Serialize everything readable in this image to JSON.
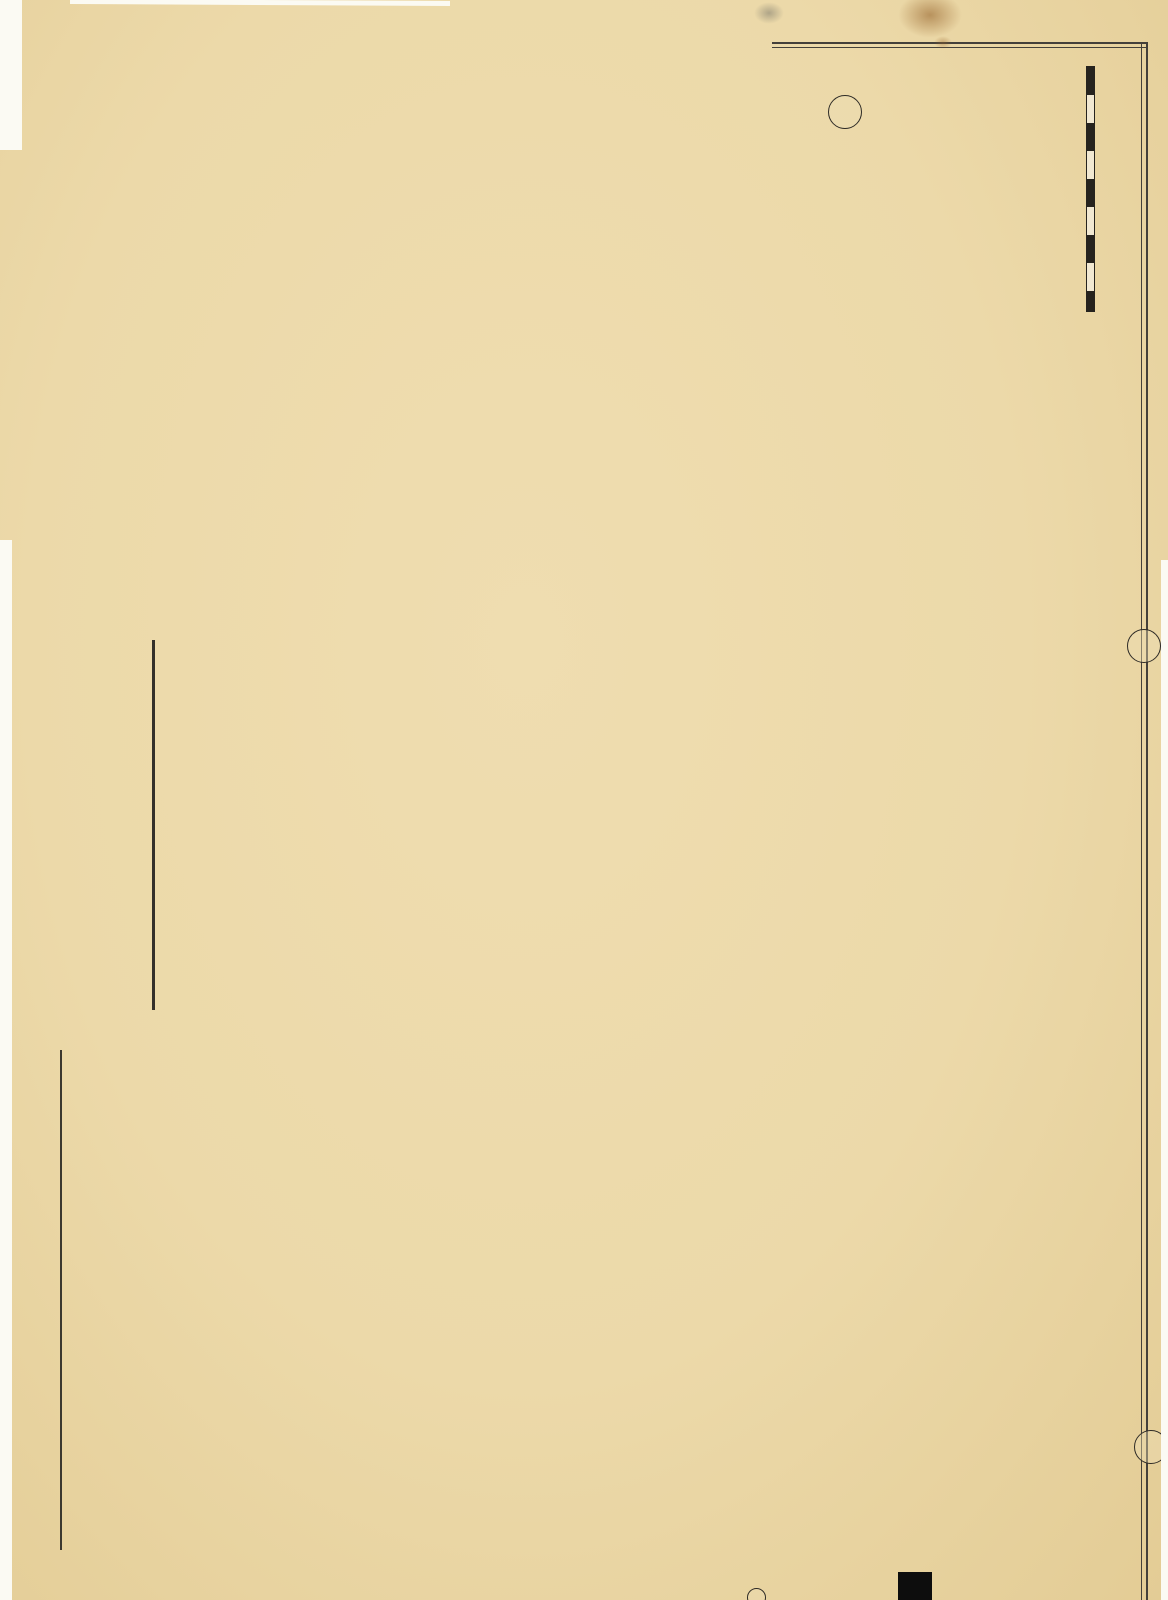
{
  "plate": {
    "number_title": "PLATE 41.",
    "city_title": "ROCHESTER.",
    "margin_note": "ALL FARM LOT Nos refer to 20,000 ACRE TRACT.",
    "scale_text": "Scale 250 feet to the inch",
    "scale_sec": "Sec.",
    "adjacent_plate_top": "23",
    "adjacent_plate_right": "40",
    "adjacent_plate_bottom": "2"
  },
  "watermark": "Historic Pictoric ®",
  "areas": {
    "maplewood": "MAPLEWOOD",
    "maplewood_park_word": "PARK",
    "genesee_river": "GENESEE RIVER",
    "seneca_park": "SENECA PARK",
    "seneca_park_strip": "SENECA PARK",
    "total_acres": "Total 115 acres",
    "kodak_park": "KODAK PARK",
    "eastman": "Eastman Kodak Co.",
    "kodak_note": "Buildings omitted upon request\nof the Eastman Kodak Co.",
    "fire_proof": "Fire Proof Film Co.",
    "fire_proof_acres": "17.32 a.",
    "ward10": "WD.10",
    "nazareth": "NAZARETH\nNORMAL\nSCHOOL",
    "town_of_greece": "TOWN OF GREECE",
    "lakeview_homestead": "LAKEVIEW HOMESTEAD",
    "gorsline": "GORSLINE",
    "maplewood_lake_tract": "MAPLEWOOD & LAKE AVE TRACT",
    "maplewood_tract": "MAPLEWOOD TRACT",
    "building": "BUILDING",
    "lot": "LOT",
    "assn": "ASS'N",
    "tract": "TRACT",
    "tract_sm": "TRACT",
    "city_big": "CITY",
    "flower_big": "FLOWER",
    "park_diag": "PARK",
    "land": "LAND",
    "sec8": "SEC. 8",
    "greece_letters": [
      "G",
      "R",
      "E",
      "E",
      "C",
      "E"
    ],
    "section_letters": [
      "A",
      "B",
      "C",
      "D",
      "E",
      "F"
    ],
    "scatter_letters": [
      "E",
      "E",
      "K",
      "T"
    ]
  },
  "farms": {
    "lucy_glass": "L u c y   G l a s s",
    "lucy_acres": "55a.",
    "stewart": "Wm & Alex W. Stewart",
    "stewart_acres": "18.87a.",
    "barker": "Hiram L. Barker",
    "barker_acres": "28.87a.",
    "britton": "W. N.  B r i t t o n",
    "britton_acres": "74 a.",
    "augell": "James E. Augell",
    "coeburn": "Geo. Coeburn",
    "heman": "Heman Glass",
    "coleman": "J. B. Coleman  4a.",
    "bygrave": "Sarah A. Bygrave",
    "city_realty": "City Realty Co."
  },
  "subs": {
    "watson": "WATSON & BROWN SUB",
    "crouch": "FRANK P. CROUCH SUB",
    "casper": "CASPER SUB",
    "langies": "LANGIE'S SUB",
    "parkdale": "PARKDALE TERRACE",
    "olmsted": "OLMSTED TRACT SUB",
    "louis": "LOUIS",
    "ellas": "ELLAS SUB"
  },
  "streets": {
    "lake": "LAKE",
    "ave": "AVE.",
    "dewey": "DEWEY",
    "ridge": "RIDGE",
    "road": "ROAD",
    "road2": "ROAD",
    "landing": "LANDING",
    "hansford": "HANSFORD",
    "lewiston": "LEWISTON",
    "knickerbocker": "KNICKERBOCKER",
    "pullman": "PULLMAN",
    "avis": "AVIS",
    "palm": "PALM",
    "dayton": "DAYTON",
    "primrose": "PRIMROSE ST",
    "marigold": "MARIGOLD ST",
    "daisy": "DAISY ST",
    "aster": "ASTER ST",
    "ridgeway": "RIDGEWAY",
    "flower_city_park": "FLOWER CITY PARK",
    "clay": "CLAY",
    "electric": "ELECTRIC",
    "magee": "MAGEE",
    "parkway": "PARKWAY",
    "seneca": "SENECA",
    "albemarle": "ALBEMARLE",
    "alameda": "ALAMEDA",
    "boulevard": "THE BOULEVARD",
    "rose": "ROSE",
    "birr": "BIRR",
    "augustine": "AUGUSTINE",
    "bronson": "BRONSON ST",
    "riverside": "RIVERSIDE",
    "maplewood_ave": "MAPLEWOOD",
    "haines": "HAINES",
    "seneca_terrace": "SENECA TERRACE",
    "burke_terrace": "BURKE TERRACE",
    "pierpont": "PIERPONT ST",
    "auckey": "AUCKEY ST",
    "spaulding": "SPAULDING ST",
    "angle": "ANGLE ST",
    "gorsline_st": "GORSLINE ST",
    "keehl": "KEEHL ST.",
    "lapham": "LAPHAM ST.",
    "lily": "LILY",
    "city_line": "CITY LINE",
    "city_line2": "CITY LINE",
    "city_line3": "CITY LINE",
    "city_parkway_line": "CITY PARKWAY LINE",
    "seneca_park_circle": "SENECA PARK CIRCLE"
  },
  "railroads": {
    "nycrr": "N.Y.C.&H.R.R.",
    "nycrr2": "N.Y.C.&H.R.R.",
    "charlotte": "CHARLOTTE BRANCH",
    "charlotte2": "CHARLOTTE BRANCH",
    "brp": "BUFF'D. ROCHESTER & PITTSBURGH R.R."
  },
  "lot_refs": [
    "S.L.Lot 25   N.L.Lot 26",
    "S.L.Lot 26   N.L.Lot 27",
    "S.L.Lot 27   N.L.Lot 28",
    "S.L.Lot 29   N.L.Lot 30",
    "S.L.Lot 31   N.L.Lot 32",
    "S.L.Lot 32   N.L.Lot 33"
  ],
  "lot_numbers_top": [
    "2",
    "3",
    "4",
    "5",
    "6",
    "7",
    "8",
    "9",
    "10",
    "11",
    "12",
    "13",
    "14",
    "15",
    "16",
    "17",
    "18"
  ],
  "lot_numbers_bottom": [
    "25",
    "26",
    "27",
    "28",
    "29",
    "30",
    "31",
    "32",
    "33"
  ],
  "colors": {
    "paper": "#ecd9a9",
    "park_green": "#cfe3ac",
    "river": "#dedbc8",
    "city_line_pink": "#ee3d90",
    "street_salmon": "#f5d0a6",
    "block_yellow": "#f1e1a4",
    "block_pink": "#f7d0bd",
    "building_yellow": "#f2cf45",
    "building_pink": "#ef4f96",
    "rail_green": "#b9d8a4"
  }
}
